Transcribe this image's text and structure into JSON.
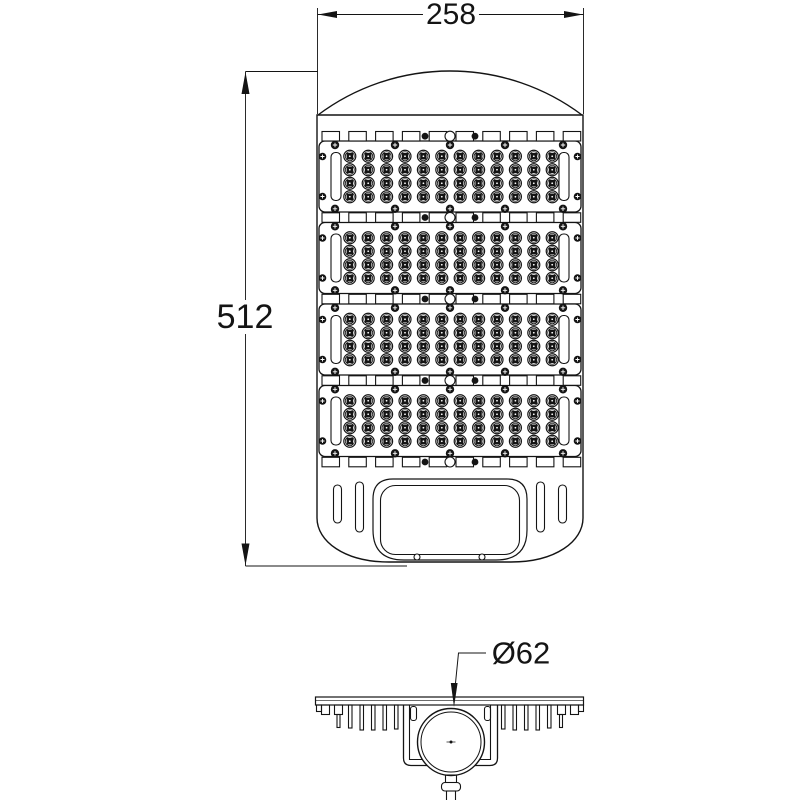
{
  "drawing": {
    "background": "#ffffff",
    "line_color": "#141414",
    "labels": {
      "width": "258",
      "height": "512",
      "pole_diameter": "Ø62"
    },
    "top_view": {
      "module_count": 4,
      "led_rows": 4,
      "led_cols": 12,
      "screw_columns": [
        335,
        395,
        450,
        505,
        563
      ],
      "strip_dot_columns": [
        425,
        475
      ],
      "tab_count": 10
    },
    "side_view": {
      "left_fin_xs": [
        348.5,
        360,
        371.5,
        383,
        394.5
      ],
      "left_fin_heights": [
        23,
        25,
        25,
        25,
        24
      ],
      "right_fin_xs": [
        501.5,
        513,
        524.5,
        536,
        547.5
      ],
      "right_fin_heights": [
        24,
        25,
        25,
        25,
        23
      ]
    }
  }
}
